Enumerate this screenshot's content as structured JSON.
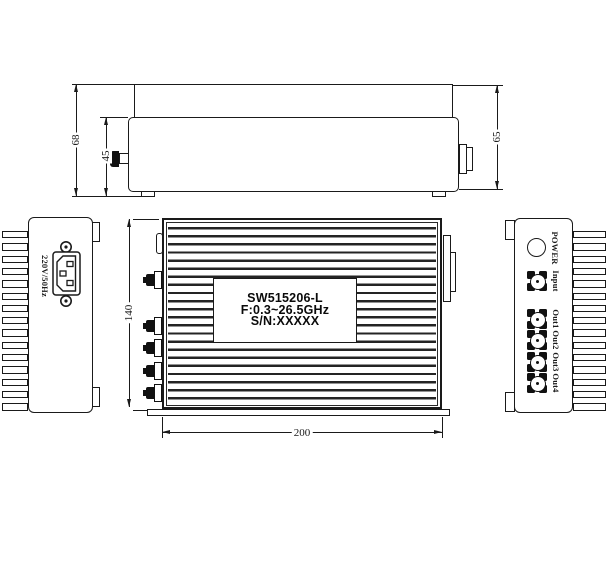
{
  "drawing": {
    "side_view": {
      "dim_total_height": "68",
      "dim_body_height": "45",
      "dim_end_height": "65"
    },
    "left_view": {
      "socket_label": "220V/50Hz"
    },
    "front_view": {
      "nameplate": {
        "line1": "SW515206-L",
        "line2": "F:0.3~26.5GHz",
        "line3": "S/N:XXXXX"
      },
      "dim_height": "140",
      "dim_width": "200"
    },
    "right_view": {
      "indicator": "POWER",
      "ports": [
        "Input",
        "Out1",
        "Out2",
        "Out3",
        "Out4"
      ]
    },
    "colors": {
      "line": "#1a1a1a",
      "background": "#ffffff"
    }
  }
}
